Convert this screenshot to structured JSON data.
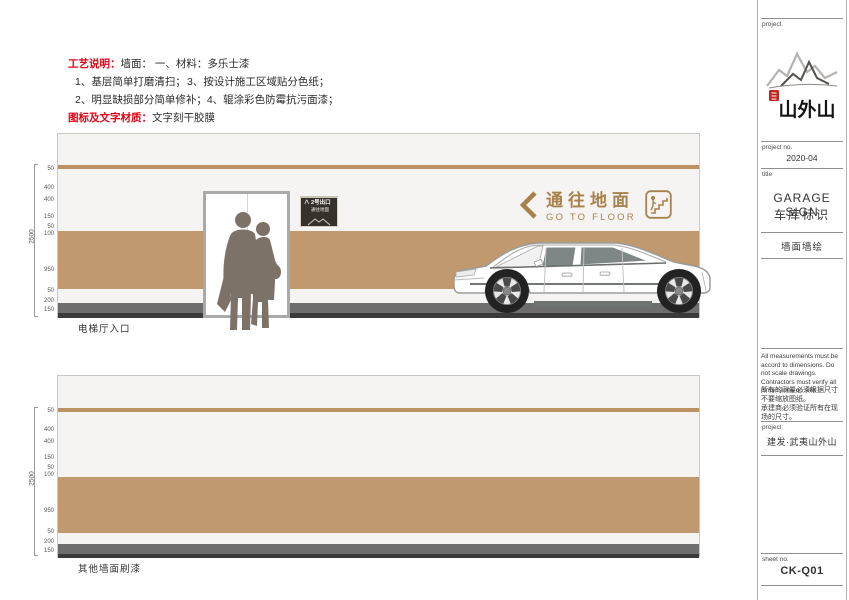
{
  "spec": {
    "label": "工艺说明：",
    "intro": "墙面： 一、材料：多乐士漆",
    "items": [
      "1、基层简单打磨清扫；",
      "3、按设计施工区域贴分色纸；",
      "2、明显缺损部分简单修补；",
      "4、辊涂彩色防霉抗污面漆；"
    ],
    "material_label": "图标及文字材质：",
    "material_value": "文字刻干胶膜"
  },
  "drawings": [
    {
      "caption": "电梯厅入口",
      "total": "2500",
      "dims": [
        "50",
        "400",
        "400",
        "150",
        "50",
        "100",
        "950",
        "50",
        "200",
        "150"
      ],
      "wall_sign": {
        "cn": "通往地面",
        "en": "GO TO FLOOR"
      },
      "exit_sign": {
        "line1": "2号出口",
        "line2": "通往地面"
      }
    },
    {
      "caption": "其他墙面刷漆",
      "total": "2500",
      "dims": [
        "50",
        "400",
        "400",
        "150",
        "50",
        "100",
        "950",
        "50",
        "200",
        "150"
      ]
    }
  ],
  "sidebar": {
    "project_label": "project",
    "logo_text": "山外山",
    "project_no_label": "project no.",
    "project_no": "2020-04",
    "title_label": "title",
    "title_en": "GARAGE SIGN",
    "title_cn": "车库标识",
    "subtitle": "墙面墙绘",
    "notes_en": "All measurements must be accord to dimensions. Do not scale drawings. Contractors must verify all dimensions on site.",
    "notes_cn_1": "所有的测量必须根据尺寸",
    "notes_cn_2": "不要缩放图纸。",
    "notes_cn_3": "承建商必须验证所有在现",
    "notes_cn_4": "场的尺寸。",
    "project2_label": "project",
    "project_name": "建发·武夷山外山",
    "sheet_label": "sheet no.",
    "sheet_no": "CK-Q01"
  },
  "colors": {
    "band_brown": "#c09a6e",
    "stripe_brown": "#bc9264",
    "sign_brown": "#a8824e",
    "accent_red": "#e60012",
    "seal_red": "#c2271f",
    "base_gray": "#6e6e6e"
  }
}
